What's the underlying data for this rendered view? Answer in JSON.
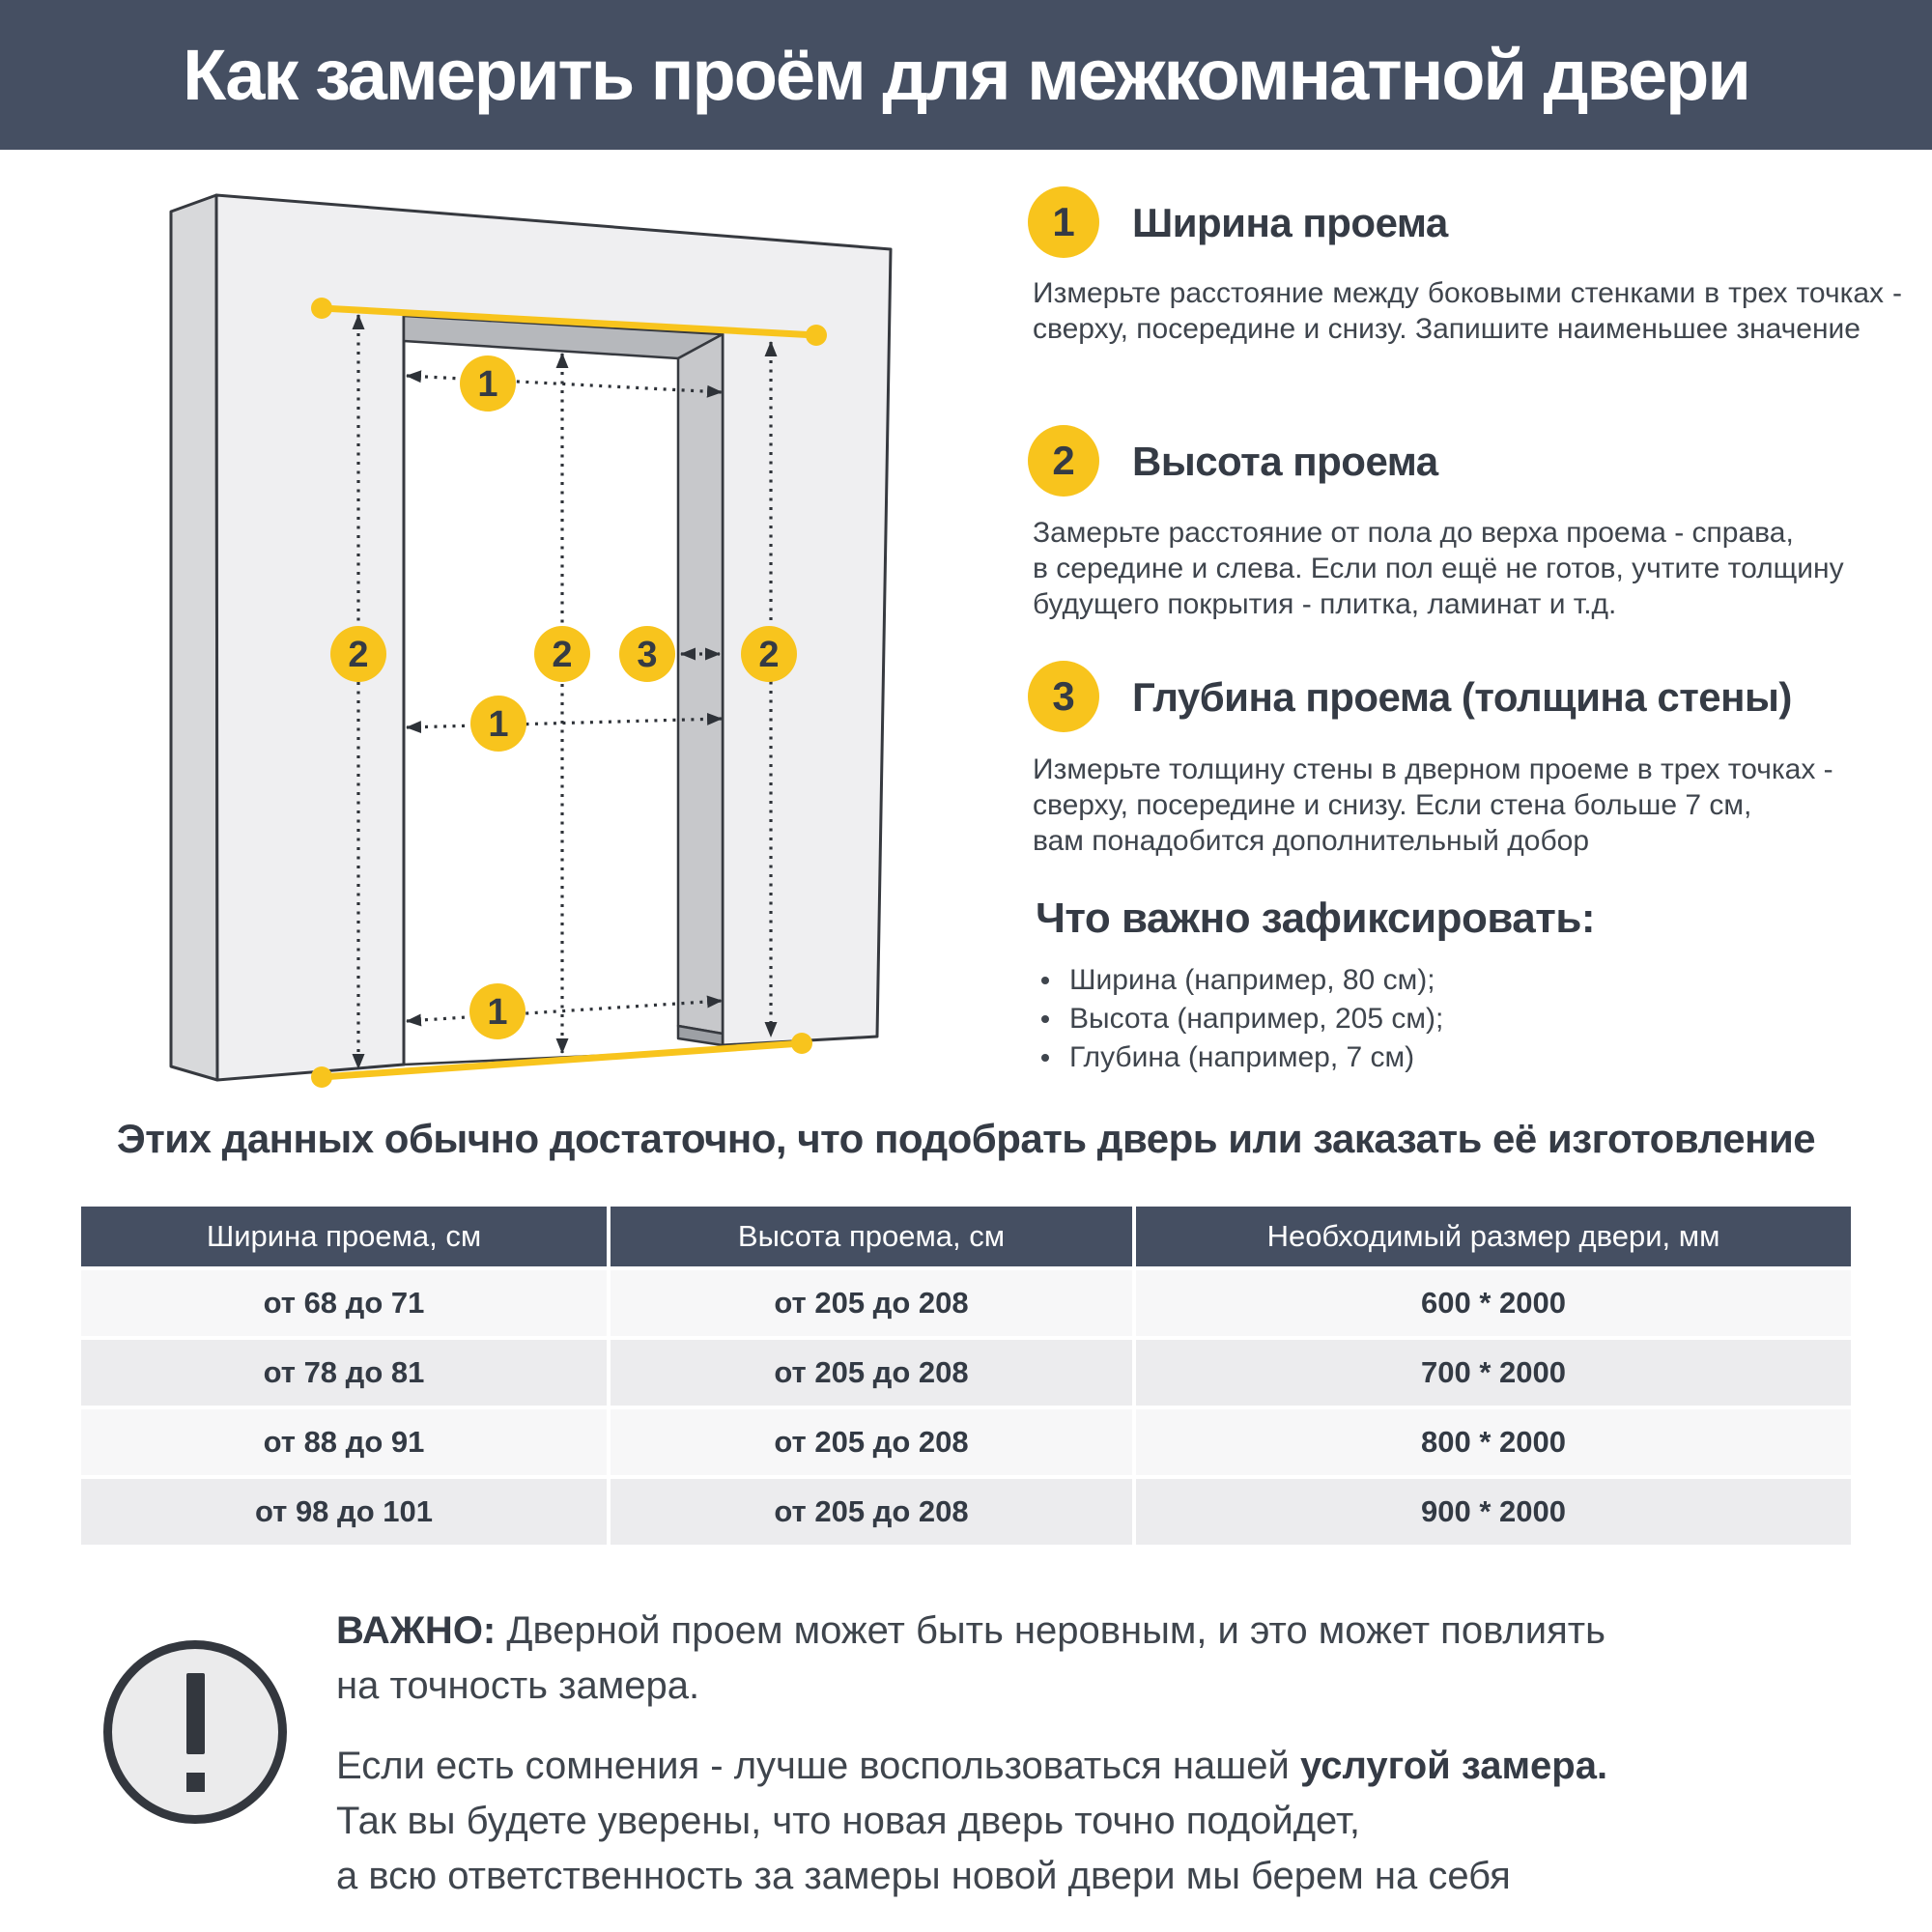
{
  "header": {
    "title": "Как замерить проём для межкомнатной двери"
  },
  "diagram": {
    "marker_width": "1",
    "marker_height": "2",
    "marker_depth": "3"
  },
  "steps": [
    {
      "num": "1",
      "title": "Ширина проема",
      "body": "Измерьте расстояние между боковыми стенками в трех точках - сверху, посередине и снизу. Запишите наименьшее значение"
    },
    {
      "num": "2",
      "title": "Высота проема",
      "body": "Замерьте расстояние от пола до верха проема - справа,\nв середине и слева. Если пол ещё не готов, учтите толщину\nбудущего покрытия - плитка, ламинат и т.д."
    },
    {
      "num": "3",
      "title": "Глубина проема (толщина стены)",
      "body": "Измерьте толщину стены в дверном проеме в трех точках -\nсверху, посередине и снизу. Если стена больше 7 см,\nвам понадобится дополнительный добор"
    }
  ],
  "checklist": {
    "title": "Что важно зафиксировать:",
    "items": [
      "Ширина (например, 80 см);",
      "Высота (например, 205 см);",
      "Глубина (например, 7 см)"
    ]
  },
  "table_section": {
    "intro": "Этих данных обычно достаточно, что подобрать дверь или заказать её изготовление",
    "headers": [
      "Ширина проема, см",
      "Высота проема, см",
      "Необходимый размер двери, мм"
    ],
    "rows": [
      [
        "от 68 до 71",
        "от 205 до 208",
        "600 * 2000"
      ],
      [
        "от 78 до 81",
        "от 205 до 208",
        "700 * 2000"
      ],
      [
        "от 88 до 91",
        "от 205 до 208",
        "800 * 2000"
      ],
      [
        "от 98 до 101",
        "от 205 до 208",
        "900 * 2000"
      ]
    ]
  },
  "important": {
    "label": "ВАЖНО:",
    "p1_rest": " Дверной проем может быть неровным, и это может повлиять\nна точность замера.",
    "p2_start": "Если есть сомнения - лучше воспользоваться нашей ",
    "p2_bold": "услугой замера.",
    "p2_rest": "\nТак вы будете уверены, что новая дверь точно подойдет,\nа всю ответственность за замеры новой двери мы берем на себя"
  },
  "colors": {
    "accent_yellow": "#F8C41D",
    "dark_slate": "#454F62",
    "text_dark": "#3B424C",
    "row_light": "#F7F7F8",
    "row_dark": "#ECECEE"
  }
}
